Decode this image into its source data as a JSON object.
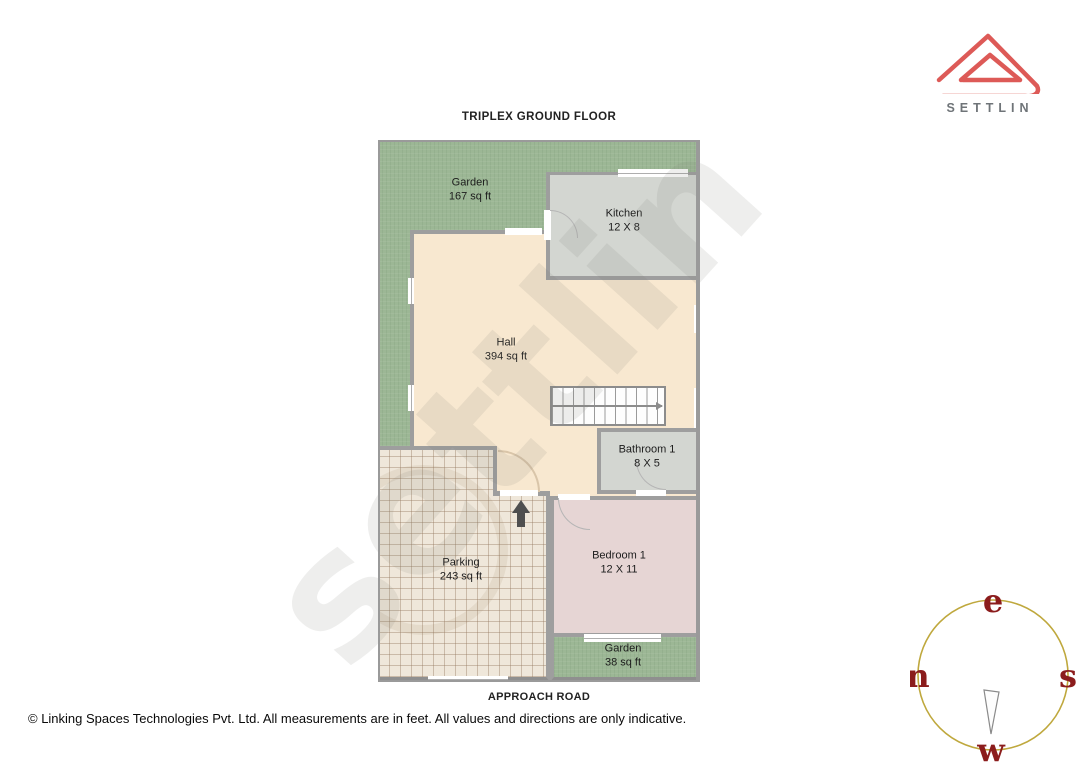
{
  "page": {
    "title": "TRIPLEX GROUND FLOOR",
    "approach_road": "APPROACH ROAD",
    "footer": "© Linking Spaces Technologies Pvt. Ltd. All measurements are in feet. All values and directions are only indicative.",
    "watermark": "settlin"
  },
  "brand": {
    "name": "SETTLIN"
  },
  "compass": {
    "top": "e",
    "left": "n",
    "right": "s",
    "bottom": "w"
  },
  "rooms": {
    "garden_top": {
      "name": "Garden",
      "size": "167 sq ft"
    },
    "kitchen": {
      "name": "Kitchen",
      "size": "12 X 8"
    },
    "hall": {
      "name": "Hall",
      "size": "394 sq ft"
    },
    "bathroom1": {
      "name": "Bathroom 1",
      "size": "8 X 5"
    },
    "bedroom1": {
      "name": "Bedroom 1",
      "size": "12 X 11"
    },
    "parking": {
      "name": "Parking",
      "size": "243 sq ft"
    },
    "garden_bottom": {
      "name": "Garden",
      "size": "38 sq ft"
    }
  },
  "colors": {
    "garden": "#9cb795",
    "hall": "#f8e8d0",
    "kitchen": "#d3d6d1",
    "bedroom": "#e6d5d4",
    "parking": "#efe7da",
    "wall": "#9e9e9e",
    "logo_accent": "#dd5a57",
    "compass_ring": "#bfa83d",
    "compass_letters": "#8b1c1c"
  }
}
